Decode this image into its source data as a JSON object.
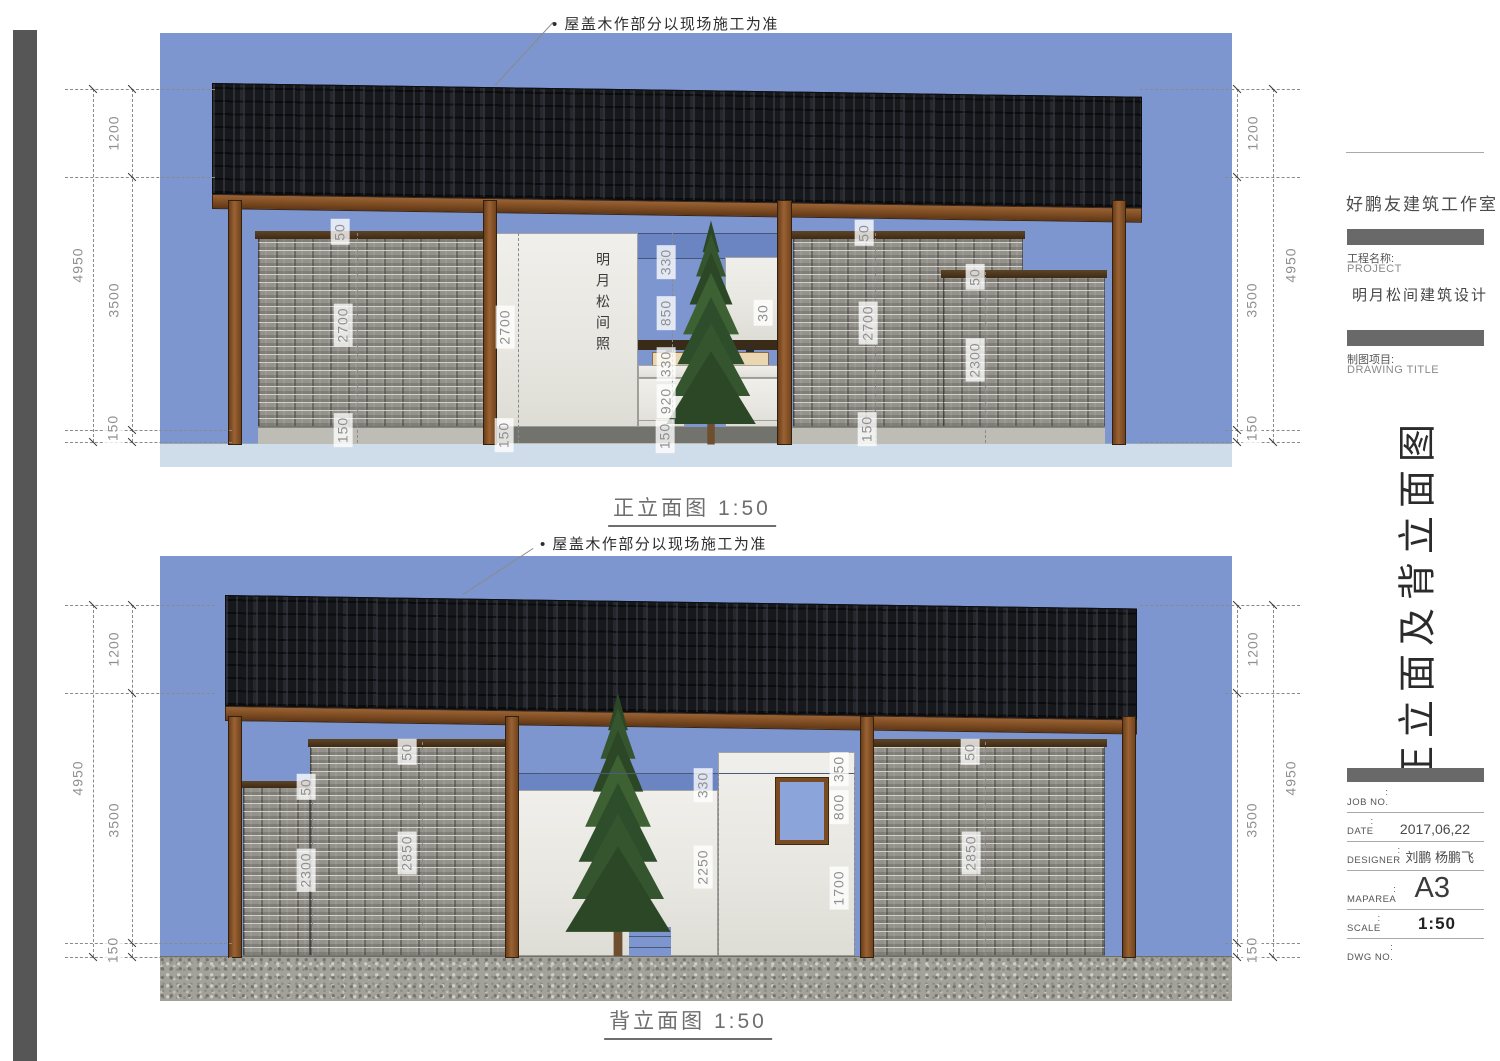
{
  "annotation": "• 屋盖木作部分以现场施工为准",
  "elevations": {
    "front_label": "正立面图 1:50",
    "back_label": "背立面图 1:50"
  },
  "wall_text": "明月松间照",
  "dims": {
    "v4950": "4950",
    "v3500": "3500",
    "v1200": "1200",
    "v150": "150",
    "v50": "50",
    "v2700": "2700",
    "v2300": "2300",
    "v2850": "2850",
    "v2250": "2250",
    "v330": "330",
    "v850": "850",
    "v920": "920",
    "v30": "30",
    "v350": "350",
    "v800": "800",
    "v1700": "1700"
  },
  "titleblock": {
    "studio": "好鹏友建筑工作室",
    "project_label_cn": "工程名称:",
    "project_label_en": "PROJECT",
    "project_name": "明月松间建筑设计",
    "drawing_label_cn": "制图项目:",
    "drawing_label_en": "DRAWING TITLE",
    "sheet_title": "正立面及背立面图",
    "colon": ":",
    "rows": [
      {
        "label": "JOB NO.",
        "value": ""
      },
      {
        "label": "DATE",
        "value": "2017,06,22"
      },
      {
        "label": "DESIGNER",
        "value": "刘鹏 杨鹏飞"
      },
      {
        "label": "MAPAREA",
        "value": "A3"
      },
      {
        "label": "SCALE",
        "value": "1:50"
      },
      {
        "label": "DWG NO.",
        "value": ""
      }
    ]
  },
  "colors": {
    "sky": "#7e96cf",
    "roof": "#17181c",
    "wood": "#8a5526",
    "brick": "#94928b",
    "accent_gray_bar": "#696969"
  }
}
